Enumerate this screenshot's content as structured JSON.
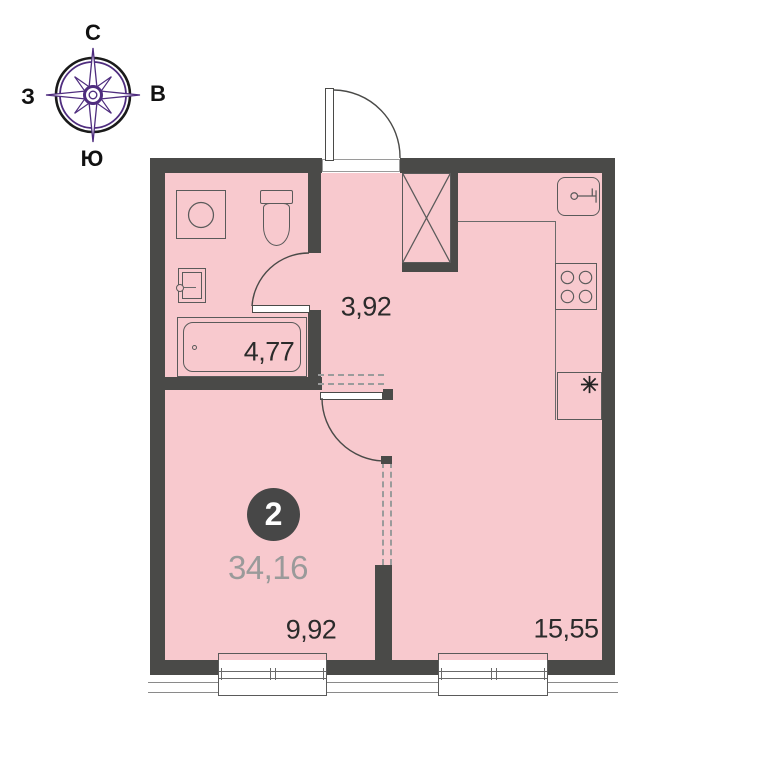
{
  "compass": {
    "north_label": "С",
    "south_label": "Ю",
    "west_label": "З",
    "east_label": "В"
  },
  "plan": {
    "badge_number": "2",
    "total_area": "34,16",
    "rooms": [
      {
        "name": "hallway",
        "area": "3,92"
      },
      {
        "name": "bathroom",
        "area": "4,77"
      },
      {
        "name": "room",
        "area": "9,92"
      },
      {
        "name": "kitchen-living-room",
        "area": "15,55"
      }
    ],
    "fixtures": [
      "washing-machine",
      "toilet",
      "bathroom-sink",
      "bathtub",
      "kitchen-sink",
      "stove",
      "refrigerator",
      "ventilation-shaft"
    ],
    "colors": {
      "wall": "#4a4a48",
      "floor": "#f8c9ce",
      "outline": "#5a5a5a",
      "badge_bg": "#474747",
      "badge_text": "#ffffff",
      "total_area_text": "#9a9a9a",
      "room_label_text": "#2b2b2b",
      "compass_purple": "#4f2d7f",
      "compass_black": "#1a1a1a"
    }
  }
}
